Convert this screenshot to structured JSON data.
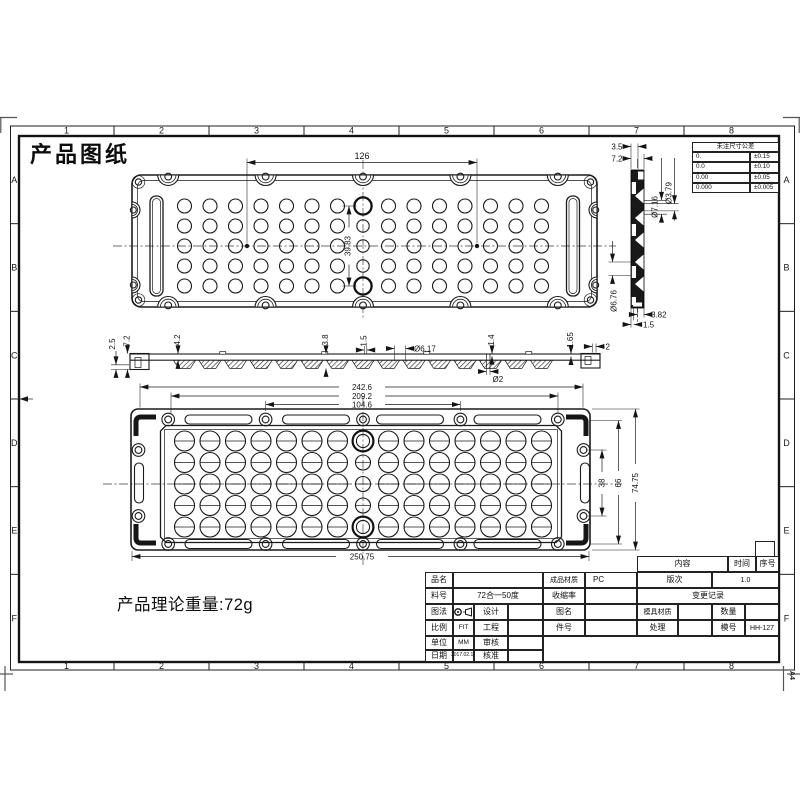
{
  "sheet": {
    "title": "产品图纸",
    "weight_note": "产品理论重量:72g",
    "paper_size": "A4",
    "grid_columns": [
      "1",
      "2",
      "3",
      "4",
      "5",
      "6",
      "7",
      "8"
    ],
    "grid_rows": [
      "A",
      "B",
      "C",
      "D",
      "E",
      "F"
    ]
  },
  "tolerance_table": {
    "header": "未注尺寸公差",
    "rows": [
      {
        "digits": "0.",
        "tol": "±0.15"
      },
      {
        "digits": "0.0",
        "tol": "±0.10"
      },
      {
        "digits": "0.00",
        "tol": "±0.05"
      },
      {
        "digits": "0.000",
        "tol": "±0.005"
      }
    ]
  },
  "dims": {
    "top_hole_spacing": "126",
    "top_hole_span": "39.83",
    "sec_step_height": "2.5",
    "sec_total_height": "7.2",
    "sec_rib_height": "4.2",
    "sec_lens_height": "3.8",
    "sec_gap": "1.5",
    "sec_lens_dia": "Ø6.17",
    "sec_plate_thk": "1.4",
    "sec_edge_height": "1.65",
    "sec_edge_width": "2",
    "sec_pin_dia": "Ø2",
    "side_step": "3.5",
    "side_total": "7.2",
    "side_hole_big": "Ø7.16",
    "side_hole_small": "Ø3.79",
    "side_hole_bottom": "Ø6.76",
    "side_bottom_w": "3.82",
    "side_bottom_w2": "1.5",
    "bottom_w1": "242.6",
    "bottom_w2": "209.2",
    "bottom_w3": "104.6",
    "bottom_w_total": "250.75",
    "bottom_h1": "38",
    "bottom_h2": "66",
    "bottom_h_total": "74.75"
  },
  "title_block": {
    "labels": {
      "product_name": "品名",
      "material": "成品材质",
      "part_no": "料号",
      "shrinkage": "收缩率",
      "projection": "图法",
      "design": "设计",
      "drawing_name": "图名",
      "scale": "比例",
      "engineering": "工程",
      "item_no": "件号",
      "unit": "单位",
      "review": "审核",
      "date": "日期",
      "approve": "核准",
      "content": "内容",
      "time": "时间",
      "serial": "序号",
      "revision": "版次",
      "change_record": "变更记录",
      "mold_material": "模具材质",
      "quantity": "数量",
      "treatment": "处理",
      "mold_no": "模号"
    },
    "values": {
      "material": "PC",
      "part_no": "72合一50度",
      "scale": "FIT",
      "unit": "MM",
      "date": "2017.02.19",
      "revision": "1.0",
      "mold_no": "HH-127"
    }
  },
  "drawing": {
    "lens_grid": {
      "columns": 15,
      "rows": 5
    }
  }
}
